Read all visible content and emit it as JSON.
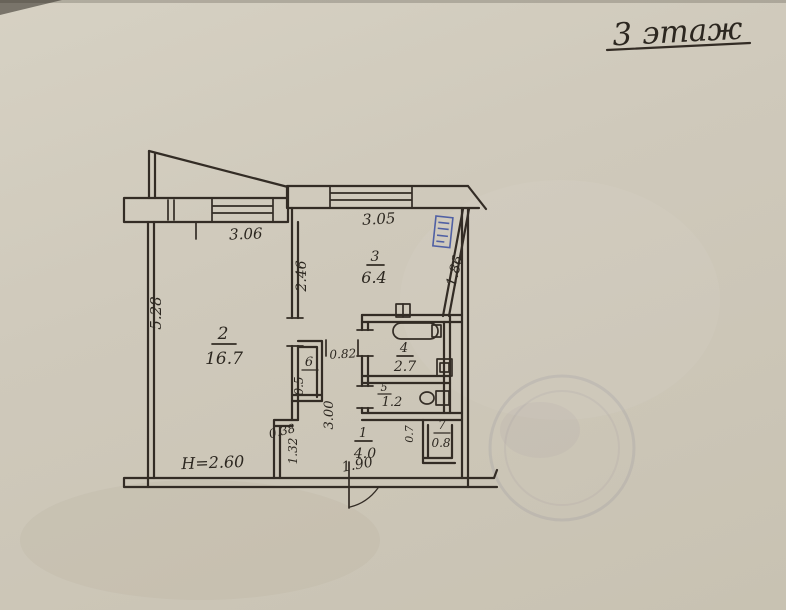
{
  "floor_title": "3 этаж",
  "rooms": [
    {
      "number": "1",
      "area": "4.0"
    },
    {
      "number": "2",
      "area": "16.7"
    },
    {
      "number": "3",
      "area": "6.4"
    },
    {
      "number": "4",
      "area": "2.7"
    },
    {
      "number": "5",
      "area": "1.2"
    },
    {
      "number": "6",
      "area": "0.5"
    },
    {
      "number": "7",
      "area": "0.8"
    }
  ],
  "dimensions": {
    "room2_width": "3.06",
    "kitchen_width": "3.05",
    "room2_depth": "5.28",
    "kitchen_depth": "2.46",
    "kitchen_slant_wall": "1.86",
    "passage_width": "0.82",
    "corridor_length": "3.00",
    "niche_depth": "0.38",
    "niche_height": "1.32",
    "hall_width": "1.90",
    "closet7_width": "0.7",
    "ceiling_height": "H=2.60"
  },
  "colors": {
    "paper": "#cfc9bb",
    "ink": "#332c25",
    "stamp_blue": "#3a4da0"
  }
}
